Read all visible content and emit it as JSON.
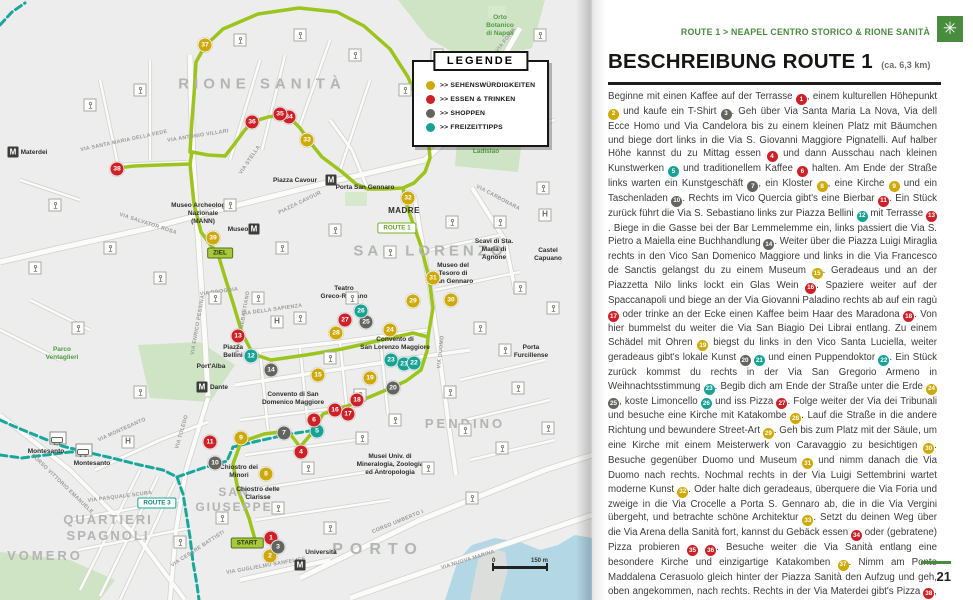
{
  "colors": {
    "accent_green": "#4a8c3f",
    "route1_green": "#9dc41d",
    "route3_teal": "#1aa79b",
    "marker_red": "#cc2127",
    "marker_yellow": "#cfa90a",
    "marker_dark": "#64645f",
    "marker_teal": "#18a296",
    "water_blue": "#b4d7e6",
    "park_green": "#cfe4c4"
  },
  "right_page": {
    "kicker": "ROUTE 1 > NEAPEL CENTRO STORICO & RIONE SANITÀ",
    "kicker_icon": "✳",
    "title": "BESCHREIBUNG ROUTE 1",
    "subtitle": "(ca. 6,3 km)",
    "page_number": "21",
    "body": [
      {
        "t": "Beginne mit einen Kaffee auf der Terrasse "
      },
      {
        "b": 1,
        "c": "red"
      },
      {
        "t": ", einem kulturellen Höhepunkt "
      },
      {
        "b": 2,
        "c": "yellow"
      },
      {
        "t": " und kaufe ein T-Shirt "
      },
      {
        "b": 3,
        "c": "dark"
      },
      {
        "t": ". Geh über Via Santa Maria La Nova, Via dell Ecce Homo und Via Candelora bis zu einem kleinen Platz mit Bäumchen und biege dort links in die Via S. Giovanni Maggiore Pignatelli. Auf halber Höhe kannst du zu Mittag essen "
      },
      {
        "b": 4,
        "c": "red"
      },
      {
        "t": " und dann Ausschau nach kleinen Kunstwerken "
      },
      {
        "b": 5,
        "c": "teal"
      },
      {
        "t": " und traditionellem Kaffee "
      },
      {
        "b": 6,
        "c": "red"
      },
      {
        "t": " halten. Am Ende der Straße links warten ein Kunstgeschäft "
      },
      {
        "b": 7,
        "c": "dark"
      },
      {
        "t": ", ein Kloster "
      },
      {
        "b": 8,
        "c": "yellow"
      },
      {
        "t": ", eine Kirche "
      },
      {
        "b": 9,
        "c": "yellow"
      },
      {
        "t": " und ein Taschenladen "
      },
      {
        "b": 10,
        "c": "dark"
      },
      {
        "t": ". Rechts im Vico Quercia gibt's eine Bierbar "
      },
      {
        "b": 11,
        "c": "red"
      },
      {
        "t": ". Ein Stück zurück führt die Via S. Sebastiano links zur Piazza Bellini "
      },
      {
        "b": 12,
        "c": "teal"
      },
      {
        "t": " mit Terrasse "
      },
      {
        "b": 13,
        "c": "red"
      },
      {
        "t": ". Biege in die Gasse bei der Bar Lemmelemme ein, links passiert die Via S. Pietro a Maiella eine Buchhandlung "
      },
      {
        "b": 14,
        "c": "dark"
      },
      {
        "t": ". Weiter über die Piazza Luigi Miraglia rechts in den Vico San Domenico Maggiore und links in die Via Francesco de Sanctis gelangst du zu einem Museum "
      },
      {
        "b": 15,
        "c": "yellow"
      },
      {
        "t": ". Geradeaus und an der Piazzetta Nilo links lockt ein Glas Wein "
      },
      {
        "b": 16,
        "c": "red"
      },
      {
        "t": ". Spaziere weiter auf der Spaccanapoli und biege an der Via Giovanni Paladino rechts ab auf ein ragù "
      },
      {
        "b": 17,
        "c": "red"
      },
      {
        "t": " oder trinke an der Ecke einen Kaffee beim Haar des Maradona "
      },
      {
        "b": 18,
        "c": "red"
      },
      {
        "t": ". Von hier bummelst du weiter die Via San Biagio Dei Librai entlang. Zu einem Schädel mit Ohren "
      },
      {
        "b": 19,
        "c": "yellow"
      },
      {
        "t": " biegst du links in den Vico Santa Luciella, weiter geradeaus gibt's lokale Kunst "
      },
      {
        "b": 20,
        "c": "dark"
      },
      {
        "t": " "
      },
      {
        "b": 21,
        "c": "teal"
      },
      {
        "t": " und einen Puppendoktor "
      },
      {
        "b": 22,
        "c": "teal"
      },
      {
        "t": ". Ein Stück zurück kommst du rechts in der Via San Gregorio Armeno in Weihnachtsstimmung "
      },
      {
        "b": 23,
        "c": "teal"
      },
      {
        "t": ". Begib dich am Ende der Straße unter die Erde "
      },
      {
        "b": 24,
        "c": "yellow"
      },
      {
        "t": " "
      },
      {
        "b": 25,
        "c": "dark"
      },
      {
        "t": ", koste Limoncello "
      },
      {
        "b": 26,
        "c": "teal"
      },
      {
        "t": " und iss Pizza "
      },
      {
        "b": 27,
        "c": "red"
      },
      {
        "t": ". Folge weiter der Via dei Tribunali und besuche eine Kirche mit Katakombe "
      },
      {
        "b": 28,
        "c": "yellow"
      },
      {
        "t": ". Lauf die Straße in die andere Richtung und bewundere Street-Art "
      },
      {
        "b": 29,
        "c": "yellow"
      },
      {
        "t": ". Geh bis zum Platz mit der Säule, um eine Kirche mit einem Meisterwerk von Caravaggio zu besichtigen "
      },
      {
        "b": 30,
        "c": "yellow"
      },
      {
        "t": ". Besuche gegenüber Duomo und Museum "
      },
      {
        "b": 31,
        "c": "yellow"
      },
      {
        "t": " und nimm danach die Via Duomo nach rechts. Nochmal rechts in der Via Luigi Settembrini wartet moderne Kunst "
      },
      {
        "b": 32,
        "c": "yellow"
      },
      {
        "t": ". Oder halte dich geradeaus, überquere die Via Foria und zweige in die Via Crocelle a Porta S. Gennaro ab, die in die Via Vergini übergeht, und betrachte schöne Architektur "
      },
      {
        "b": 33,
        "c": "yellow"
      },
      {
        "t": ". Setzt du deinen Weg über die Via Arena della Sanità fort, kannst du Gebäck essen "
      },
      {
        "b": 34,
        "c": "red"
      },
      {
        "t": " oder (gebratene) Pizza probieren "
      },
      {
        "b": 35,
        "c": "red"
      },
      {
        "t": " "
      },
      {
        "b": 36,
        "c": "red"
      },
      {
        "t": ". Besuche weiter die Via Sanità entlang eine besondere Kirche und einzigartige Katakomben "
      },
      {
        "b": 37,
        "c": "yellow"
      },
      {
        "t": ". Nimm am Ponte Maddalena Cerasuolo gleich hinter der Piazza Sanità den Aufzug und geh, oben angekommen, nach rechts. Rechts in der Via Materdei gibt's Pizza "
      },
      {
        "b": 38,
        "c": "red"
      },
      {
        "t": ", geradeaus auf der Via Santa Teresa degli Scalzi landest du schließlich beim Archäologischen Museum "
      },
      {
        "b": 39,
        "c": "yellow"
      },
      {
        "t": "."
      }
    ]
  },
  "map": {
    "legend": {
      "title": "LEGENDE",
      "items": [
        {
          "label": ">> SEHENSWÜRDIGKEITEN",
          "color": "yellow"
        },
        {
          "label": ">> ESSEN & TRINKEN",
          "color": "red"
        },
        {
          "label": ">> SHOPPEN",
          "color": "dark"
        },
        {
          "label": ">> FREIZEITTIPPS",
          "color": "teal"
        }
      ]
    },
    "big_labels": [
      {
        "text": "RIONE SANITÀ",
        "x": 262,
        "y": 85,
        "size": 15,
        "ls": 5
      },
      {
        "text": "SAN LORENZO",
        "x": 430,
        "y": 252,
        "size": 15,
        "ls": 4
      },
      {
        "text": "PENDINO",
        "x": 465,
        "y": 424,
        "size": 13,
        "ls": 3
      },
      {
        "text": "QUARTIERI\nSPAGNOLI",
        "x": 108,
        "y": 528,
        "size": 13,
        "ls": 2
      },
      {
        "text": "SAN\nGIUSEPPE",
        "x": 234,
        "y": 500,
        "size": 12,
        "ls": 2
      },
      {
        "text": "VOMERO",
        "x": 45,
        "y": 556,
        "size": 13,
        "ls": 3
      },
      {
        "text": "PORTO",
        "x": 378,
        "y": 550,
        "size": 16,
        "ls": 7
      }
    ],
    "places": [
      {
        "text": "Orto\nBotanico\ndi Napoli",
        "x": 500,
        "y": 26,
        "cls": "green"
      },
      {
        "text": "Parco Re\nLadislao",
        "x": 486,
        "y": 148,
        "cls": "green"
      },
      {
        "text": "Parco\nVentaglieri",
        "x": 62,
        "y": 354,
        "cls": "green"
      },
      {
        "text": "Materdei",
        "x": 34,
        "y": 153,
        "cls": ""
      },
      {
        "text": "Piazza Cavour",
        "x": 295,
        "y": 181,
        "cls": ""
      },
      {
        "text": "Porta San Gennaro",
        "x": 365,
        "y": 188,
        "cls": ""
      },
      {
        "text": "Museo Archeologico\nNazionale\n(MANN)",
        "x": 203,
        "y": 214,
        "cls": ""
      },
      {
        "text": "Museo",
        "x": 238,
        "y": 230,
        "cls": ""
      },
      {
        "text": "MADRE",
        "x": 404,
        "y": 211,
        "cls": "bold-lg"
      },
      {
        "text": "Scavi di Sta.\nMaria di\nAgnone",
        "x": 494,
        "y": 250,
        "cls": ""
      },
      {
        "text": "Castel\nCapuano",
        "x": 548,
        "y": 255,
        "cls": ""
      },
      {
        "text": "Museo del\nTesoro di\nSan Gennaro",
        "x": 453,
        "y": 274,
        "cls": ""
      },
      {
        "text": "Teatro\nGreco-Romano",
        "x": 344,
        "y": 293,
        "cls": ""
      },
      {
        "text": "Convento di\nSan Lorenzo Maggiore",
        "x": 395,
        "y": 344,
        "cls": ""
      },
      {
        "text": "Piazza\nBellini",
        "x": 233,
        "y": 352,
        "cls": ""
      },
      {
        "text": "Port'Alba",
        "x": 211,
        "y": 367,
        "cls": ""
      },
      {
        "text": "Dante",
        "x": 219,
        "y": 388,
        "cls": ""
      },
      {
        "text": "Convento di San\nDomenico Maggiore",
        "x": 293,
        "y": 399,
        "cls": ""
      },
      {
        "text": "Porta\nFurcillense",
        "x": 531,
        "y": 352,
        "cls": ""
      },
      {
        "text": "Musei Univ. di\nMineralogia, Zoologia\ned Antropologia",
        "x": 390,
        "y": 465,
        "cls": ""
      },
      {
        "text": "Chiostro dei\nMinori",
        "x": 239,
        "y": 472,
        "cls": ""
      },
      {
        "text": "Chiostro delle\nClarisse",
        "x": 258,
        "y": 494,
        "cls": ""
      },
      {
        "text": "Montesanto",
        "x": 46,
        "y": 452,
        "cls": ""
      },
      {
        "text": "Montesanto",
        "x": 92,
        "y": 464,
        "cls": ""
      },
      {
        "text": "Università",
        "x": 321,
        "y": 553,
        "cls": ""
      }
    ],
    "streets": [
      {
        "text": "VIA FORIA",
        "x": 506,
        "y": 40,
        "r": -52
      },
      {
        "text": "VIA SALVATOR ROSA",
        "x": 148,
        "y": 224,
        "r": 18
      },
      {
        "text": "PIAZZA CAVOUR",
        "x": 300,
        "y": 203,
        "r": -26
      },
      {
        "text": "VIA CARBONARA",
        "x": 498,
        "y": 198,
        "r": 28
      },
      {
        "text": "VIA DELLA SAPIENZA",
        "x": 272,
        "y": 310,
        "r": -8
      },
      {
        "text": "VIA BROGGIA",
        "x": 219,
        "y": 292,
        "r": -8
      },
      {
        "text": "VIA ENRICO PESSINA",
        "x": 198,
        "y": 325,
        "r": -80
      },
      {
        "text": "VIA DUOMO",
        "x": 441,
        "y": 352,
        "r": -84
      },
      {
        "text": "VIA TOLEDO",
        "x": 182,
        "y": 432,
        "r": -74
      },
      {
        "text": "CORSO UMBERTO I",
        "x": 398,
        "y": 522,
        "r": -22
      },
      {
        "text": "VIA NUOVA MARINA",
        "x": 468,
        "y": 560,
        "r": -17
      },
      {
        "text": "VIA GUGLIELMO SANFELICE",
        "x": 266,
        "y": 566,
        "r": -10
      },
      {
        "text": "CORSO VITTORIO EMANUELE",
        "x": 62,
        "y": 484,
        "r": 44
      },
      {
        "text": "VIA PASQUALE SCURA",
        "x": 120,
        "y": 497,
        "r": -7
      },
      {
        "text": "VIA MONTESANTO",
        "x": 122,
        "y": 430,
        "r": -24
      },
      {
        "text": "VIA STELLA",
        "x": 250,
        "y": 160,
        "r": -56
      },
      {
        "text": "VIA ANTONIO VILLARI",
        "x": 198,
        "y": 136,
        "r": -9
      },
      {
        "text": "VIA SANTA MARIA DELLA FEDE",
        "x": 124,
        "y": 141,
        "r": -12
      },
      {
        "text": "VIA CESARE BATTISTI",
        "x": 198,
        "y": 549,
        "r": -33
      },
      {
        "text": "VIA SAN SEBASTIANO",
        "x": 243,
        "y": 322,
        "r": -80
      }
    ],
    "markers": [
      {
        "n": 1,
        "x": 271,
        "y": 538,
        "c": "red"
      },
      {
        "n": 2,
        "x": 270,
        "y": 556,
        "c": "yellow"
      },
      {
        "n": 3,
        "x": 278,
        "y": 547,
        "c": "dark"
      },
      {
        "n": 4,
        "x": 301,
        "y": 452,
        "c": "red"
      },
      {
        "n": 5,
        "x": 317,
        "y": 431,
        "c": "teal"
      },
      {
        "n": 6,
        "x": 314,
        "y": 420,
        "c": "red"
      },
      {
        "n": 7,
        "x": 284,
        "y": 433,
        "c": "dark"
      },
      {
        "n": 8,
        "x": 266,
        "y": 474,
        "c": "yellow"
      },
      {
        "n": 9,
        "x": 241,
        "y": 438,
        "c": "yellow"
      },
      {
        "n": 10,
        "x": 215,
        "y": 463,
        "c": "dark"
      },
      {
        "n": 11,
        "x": 210,
        "y": 442,
        "c": "red"
      },
      {
        "n": 12,
        "x": 251,
        "y": 356,
        "c": "teal"
      },
      {
        "n": 13,
        "x": 238,
        "y": 336,
        "c": "red"
      },
      {
        "n": 14,
        "x": 271,
        "y": 370,
        "c": "dark"
      },
      {
        "n": 15,
        "x": 318,
        "y": 375,
        "c": "yellow"
      },
      {
        "n": 16,
        "x": 335,
        "y": 410,
        "c": "red"
      },
      {
        "n": 17,
        "x": 348,
        "y": 414,
        "c": "red"
      },
      {
        "n": 18,
        "x": 357,
        "y": 400,
        "c": "red"
      },
      {
        "n": 19,
        "x": 370,
        "y": 378,
        "c": "yellow"
      },
      {
        "n": 20,
        "x": 393,
        "y": 388,
        "c": "dark"
      },
      {
        "n": 21,
        "x": 404,
        "y": 364,
        "c": "teal"
      },
      {
        "n": 22,
        "x": 414,
        "y": 363,
        "c": "teal"
      },
      {
        "n": 23,
        "x": 391,
        "y": 360,
        "c": "teal"
      },
      {
        "n": 24,
        "x": 390,
        "y": 330,
        "c": "yellow"
      },
      {
        "n": 25,
        "x": 366,
        "y": 322,
        "c": "dark"
      },
      {
        "n": 26,
        "x": 361,
        "y": 311,
        "c": "teal"
      },
      {
        "n": 27,
        "x": 345,
        "y": 320,
        "c": "red"
      },
      {
        "n": 28,
        "x": 336,
        "y": 333,
        "c": "yellow"
      },
      {
        "n": 29,
        "x": 413,
        "y": 301,
        "c": "yellow"
      },
      {
        "n": 30,
        "x": 451,
        "y": 300,
        "c": "yellow"
      },
      {
        "n": 31,
        "x": 433,
        "y": 278,
        "c": "yellow"
      },
      {
        "n": 32,
        "x": 408,
        "y": 198,
        "c": "yellow"
      },
      {
        "n": 33,
        "x": 307,
        "y": 140,
        "c": "yellow"
      },
      {
        "n": 34,
        "x": 289,
        "y": 117,
        "c": "red"
      },
      {
        "n": 35,
        "x": 280,
        "y": 114,
        "c": "red"
      },
      {
        "n": 36,
        "x": 252,
        "y": 122,
        "c": "red"
      },
      {
        "n": 37,
        "x": 205,
        "y": 45,
        "c": "yellow"
      },
      {
        "n": 38,
        "x": 117,
        "y": 169,
        "c": "red"
      },
      {
        "n": 39,
        "x": 213,
        "y": 238,
        "c": "yellow"
      }
    ],
    "route_badges": [
      {
        "text": "START",
        "x": 247,
        "y": 543,
        "style": "solid"
      },
      {
        "text": "ZIEL",
        "x": 220,
        "y": 253,
        "style": "solid"
      },
      {
        "text": "ROUTE 1",
        "x": 397,
        "y": 228,
        "style": "outg"
      },
      {
        "text": "ROUTE 3",
        "x": 157,
        "y": 503,
        "style": "outt"
      }
    ],
    "metro_stations": [
      {
        "x": 13,
        "y": 152
      },
      {
        "x": 331,
        "y": 180
      },
      {
        "x": 254,
        "y": 229
      },
      {
        "x": 202,
        "y": 387
      },
      {
        "x": 300,
        "y": 565
      }
    ],
    "funicular_stations": [
      {
        "x": 58,
        "y": 438
      },
      {
        "x": 84,
        "y": 450
      }
    ],
    "hospitals": [
      {
        "x": 277,
        "y": 322
      },
      {
        "x": 128,
        "y": 442
      },
      {
        "x": 545,
        "y": 215
      }
    ],
    "scale": {
      "left": "0",
      "right": "150 m"
    }
  }
}
